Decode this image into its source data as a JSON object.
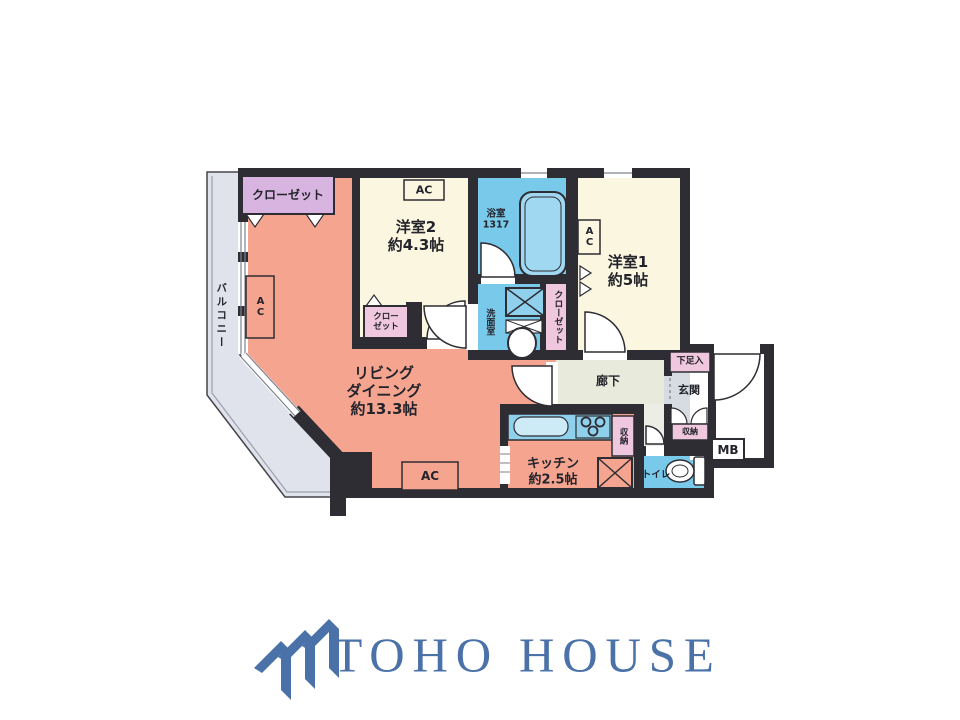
{
  "floorplan": {
    "colors": {
      "wall": "#2e2d33",
      "living_dining": "#f5a58f",
      "bedroom": "#faf6df",
      "wet_area_blue": "#79c9ea",
      "closet_pink": "#efc7de",
      "closet_lavender": "#d8b5e0",
      "hallway_green": "#e8ebdb",
      "genkan_gray": "#d7dbe2",
      "balcony_gray": "#e0e3eb"
    },
    "labels": {
      "balcony": "バルコニー",
      "closet": "クローゼット",
      "closet_l1": "クロー",
      "closet_l2": "ゼット",
      "ac": "AC",
      "room2_name": "洋室2",
      "room2_size": "約4.3帖",
      "bath_name": "浴室",
      "bath_size": "1317",
      "room1_name": "洋室1",
      "room1_size": "約5帖",
      "washroom": "洗面室",
      "ld_l1": "リビング",
      "ld_l2": "ダイニング",
      "ld_l3": "約13.3帖",
      "hallway": "廊下",
      "shoe_cabinet": "下足入",
      "entrance": "玄関",
      "storage": "収納",
      "mb": "MB",
      "toilet": "トイレ",
      "kitchen_name": "キッチン",
      "kitchen_size": "約2.5帖"
    }
  },
  "logo": {
    "text": "TOHO HOUSE",
    "color": "#4a72a8",
    "icon": "triple-roof-chevron-icon"
  }
}
